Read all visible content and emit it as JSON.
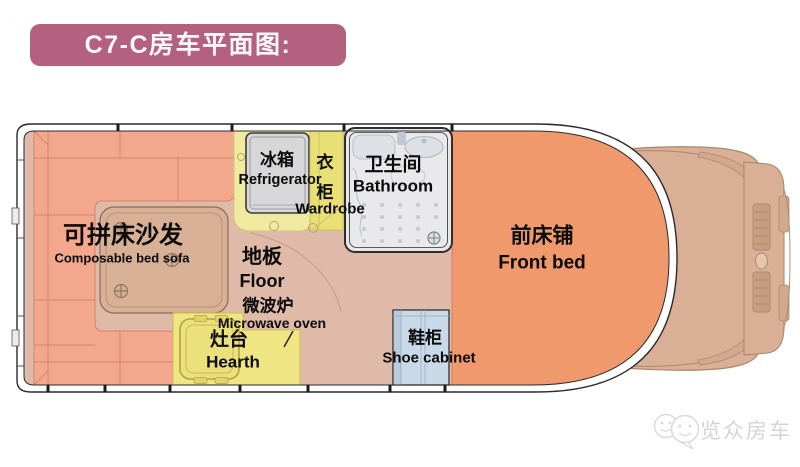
{
  "banner": {
    "title": "C7-C房车平面图:"
  },
  "rooms": {
    "sofa": {
      "cn": "可拼床沙发",
      "en": "Composable bed sofa"
    },
    "refrigerator": {
      "cn": "冰箱",
      "en": "Refrigerator"
    },
    "wardrobe": {
      "cn": "衣柜",
      "en": "Wardrobe"
    },
    "bathroom": {
      "cn": "卫生间",
      "en": "Bathroom"
    },
    "floor": {
      "cn": "地板",
      "en": "Floor"
    },
    "microwave": {
      "cn": "微波炉",
      "en": "Microwave oven"
    },
    "hearth": {
      "cn": "灶台",
      "en": "Hearth"
    },
    "shoe_cabinet": {
      "cn": "鞋柜",
      "en": "Shoe cabinet"
    },
    "front_bed": {
      "cn": "前床铺",
      "en": "Front bed"
    }
  },
  "watermark": {
    "brand": "览众房车"
  },
  "colors": {
    "banner_bg": "#b4617f",
    "sofa": "#f3a88d",
    "front_bed": "#f0996c",
    "floor": "#dfbaa8",
    "kitchen_yellow": "#efe583",
    "counter_yellow": "#f0e9a0",
    "wardrobe_yellow": "#e8e075",
    "shoe_cabinet_blue": "#c9d9e7",
    "bathroom_grey": "#e9e9ec",
    "fridge_grey": "#d7d7da",
    "cab_tan": "#d9b096",
    "wall_line": "#2b2b2b"
  }
}
